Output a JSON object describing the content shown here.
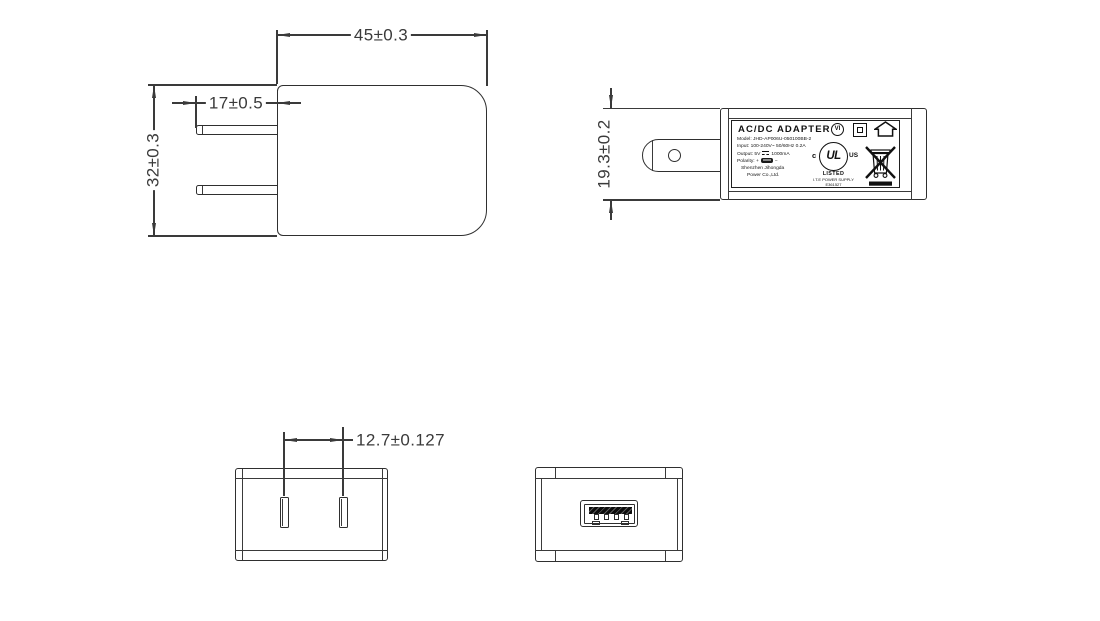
{
  "drawing": {
    "dims": {
      "body_width": "45±0.3",
      "prong_length": "17±0.5",
      "body_height": "32±0.3",
      "body_thickness": "19.3±0.2",
      "pin_spacing": "12.7±0.127"
    },
    "label": {
      "title": "AC/DC ADAPTER",
      "model": "Model: JHD-AP006U-050100BB-2",
      "input": "Input: 100-240V~ 50/60Hz 0.2A",
      "output_prefix": "Output: 5V",
      "output_suffix": "1000mA",
      "polarity_prefix": "Polarity:",
      "polarity_plus": "+",
      "polarity_minus": "−",
      "company_line1": "Shenzhen Jihongda",
      "company_line2": "Power Co.,Ltd.",
      "marks": {
        "efficiency_level": "VI",
        "ul_monogram": "UL",
        "ul_c": "c",
        "ul_us": "US",
        "ul_listed": "LISTED",
        "ul_type": "I.T.E POWER SUPPLY",
        "ul_file_number": "E361527"
      }
    },
    "icons": {
      "efficiency_mark": "circled-VI",
      "class_ii": "double-square",
      "indoor_use_only": "house",
      "ul_recognition": "cULus-listed-circle",
      "weee": "crossed-out-wheeled-bin-with-bar",
      "polarity_connector": "usb-a-plug",
      "dc_output": "solid-over-dashed-line"
    },
    "colors": {
      "line": "#3a3a3a",
      "outline": "#2f2f2f",
      "label_text": "#111111",
      "usb_contact_bar": "#1a1a1a",
      "background": "#ffffff"
    }
  }
}
